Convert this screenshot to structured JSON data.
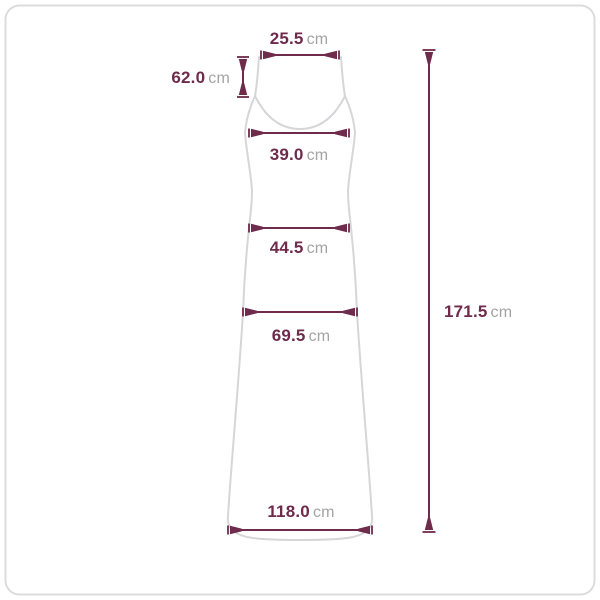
{
  "colors": {
    "measure": "#6E2B4C",
    "unit": "#A4A4A4",
    "garment": "#D6D6D8",
    "panel_border": "#DCDCDC",
    "panel_bg": "#FFFFFF"
  },
  "measurements": {
    "top_width": {
      "value": "25.5",
      "unit": "cm"
    },
    "strap_length": {
      "value": "62.0",
      "unit": "cm"
    },
    "chest_width": {
      "value": "39.0",
      "unit": "cm"
    },
    "waist_width": {
      "value": "44.5",
      "unit": "cm"
    },
    "hip_width": {
      "value": "69.5",
      "unit": "cm"
    },
    "hem_width": {
      "value": "118.0",
      "unit": "cm"
    },
    "total_length": {
      "value": "171.5",
      "unit": "cm"
    }
  }
}
